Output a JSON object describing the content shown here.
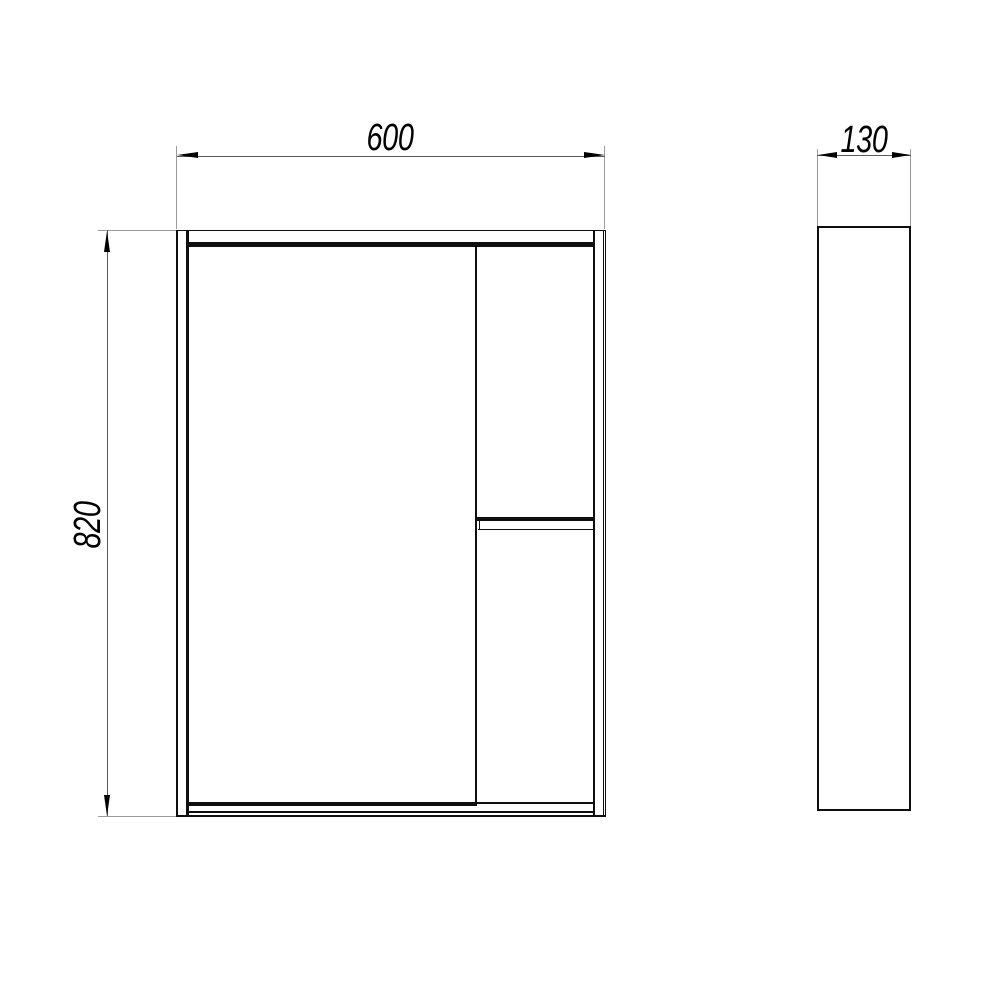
{
  "drawing": {
    "description": "cabinet-two-view-technical-drawing",
    "dimensions": {
      "width": {
        "value": "600"
      },
      "height": {
        "value": "820"
      },
      "depth": {
        "value": "130"
      }
    },
    "colors": {
      "background": "#ffffff",
      "object_line": "#0f0f0f",
      "dimension_line": "#5a5a5a",
      "extension_line": "#9a9a9a",
      "text": "#000000"
    }
  }
}
